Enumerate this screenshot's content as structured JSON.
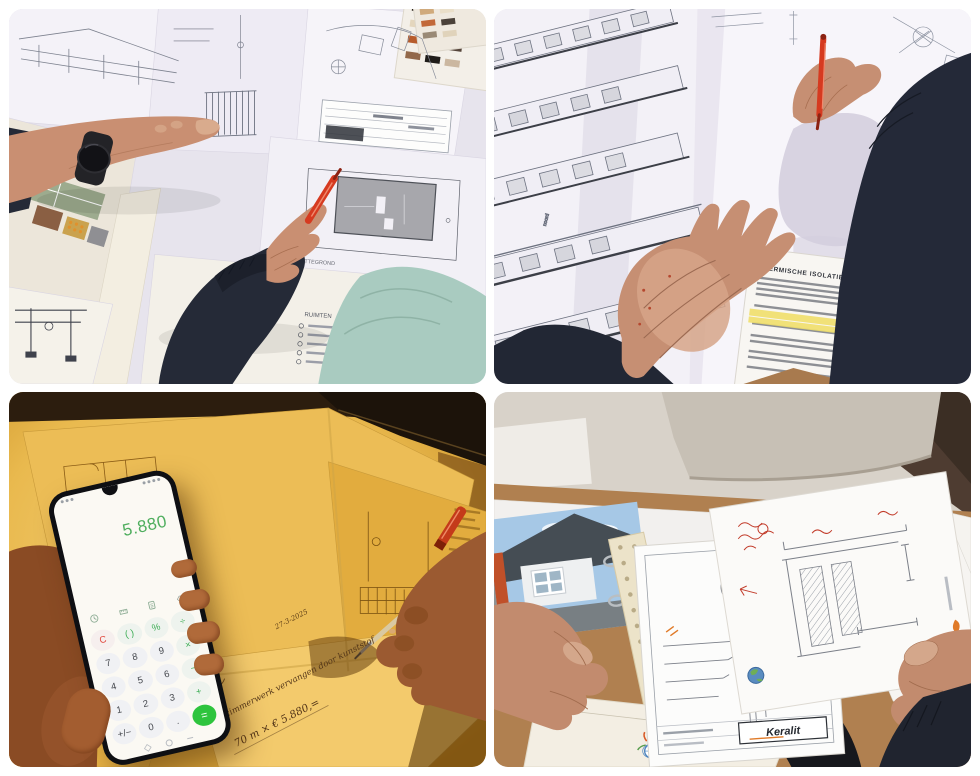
{
  "panels": {
    "top_left": {
      "labels": {
        "plan": "PLATTEGROND",
        "rooms": "RUIMTEN"
      }
    },
    "top_right": {
      "labels": {
        "spec_header": "THERMISCHE ISOLATIE WAARDEN",
        "legend": "RENVOOI",
        "orientation": "noord"
      }
    },
    "bottom_left": {
      "calculator": {
        "display": "5.880",
        "keys": [
          {
            "label": "C"
          },
          {
            "label": "( )"
          },
          {
            "label": "%"
          },
          {
            "label": "÷"
          },
          {
            "label": "7"
          },
          {
            "label": "8"
          },
          {
            "label": "9"
          },
          {
            "label": "×"
          },
          {
            "label": "4"
          },
          {
            "label": "5"
          },
          {
            "label": "6"
          },
          {
            "label": "−"
          },
          {
            "label": "1"
          },
          {
            "label": "2"
          },
          {
            "label": "3"
          },
          {
            "label": "+"
          },
          {
            "label": "+/−"
          },
          {
            "label": "0"
          },
          {
            "label": "."
          },
          {
            "label": "="
          }
        ]
      },
      "handwriting": {
        "date": "27-3-2025",
        "line1": "al timmerwerk vervangen door kunststof",
        "line2": "70 m × € 5.880,="
      }
    },
    "bottom_right": {
      "labels": {
        "detail_ref": "2A",
        "brand": "Keralit"
      }
    }
  },
  "colors": {
    "calculator_green": "#4fae5e",
    "equals_green": "#2ec43d",
    "clear_red": "#e0443a",
    "pen_red": "#d63a20",
    "amber_light": "#eec05a",
    "navy_sleeve": "#242936",
    "highlight_yellow": "#efdf6a"
  }
}
